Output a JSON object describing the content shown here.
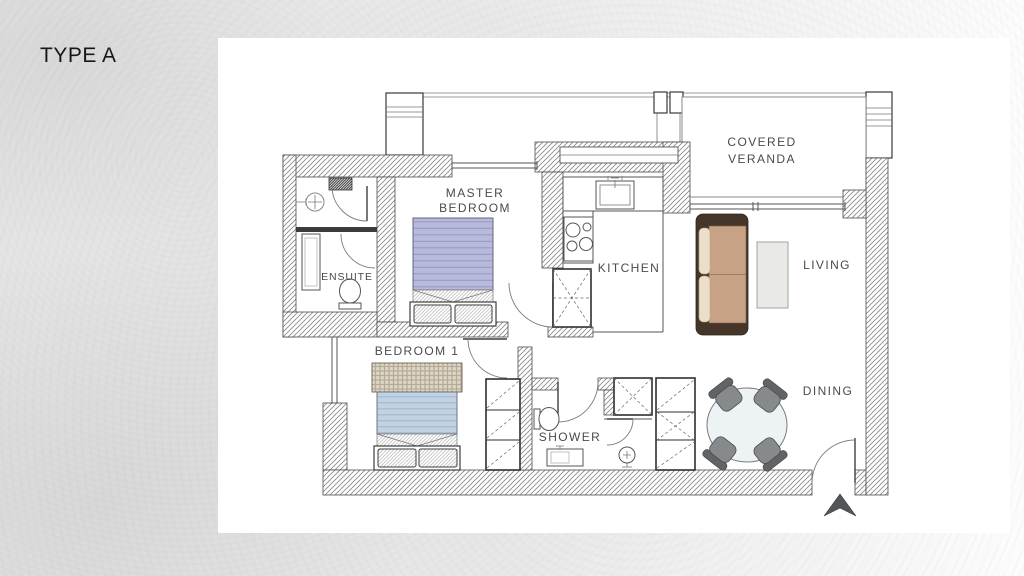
{
  "page": {
    "title_label": "TYPE A"
  },
  "plan": {
    "rooms": {
      "master_bedroom": {
        "line1": "MASTER",
        "line2": "BEDROOM"
      },
      "covered_veranda": {
        "line1": "COVERED",
        "line2": "VERANDA"
      },
      "kitchen": {
        "label": "KITCHEN"
      },
      "living": {
        "label": "LIVING"
      },
      "dining": {
        "label": "DINING"
      },
      "bedroom1": {
        "label": "BEDROOM 1"
      },
      "shower": {
        "label": "SHOWER"
      },
      "ensuite": {
        "label": "ENSUITE"
      }
    },
    "colors": {
      "label_text": "#4a4a4a",
      "wall_hatch": "#878787",
      "wall_outline": "#4c4c4c",
      "master_bed_blanket": "#b8badb",
      "bedroom1_blanket": "#c2d2e3",
      "bedroom1_headboard": "#ddd8ca",
      "sofa_frame": "#46362a",
      "sofa_seat": "#c8a284",
      "sofa_cushion": "#ebdfc9",
      "coffee_table": "#e9e9e5",
      "dining_table": "#edf2f4",
      "chair": "#868a8d",
      "chair_back": "#606467",
      "entrance_arrow": "#51565a"
    }
  }
}
